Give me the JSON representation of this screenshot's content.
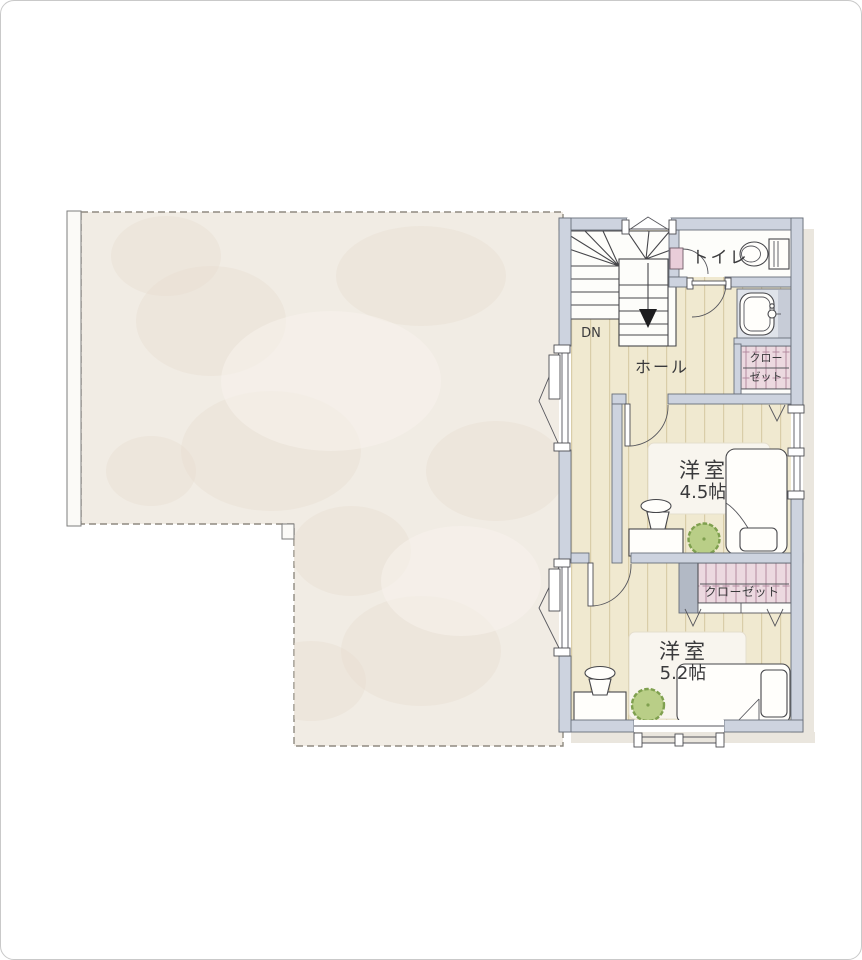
{
  "plan": {
    "labels": {
      "dn": "DN",
      "toilet": "トイレ",
      "hall": "ホール",
      "closet_upper": [
        "クロー",
        "ゼット"
      ],
      "closet_lower": "クローゼット",
      "room_a": {
        "name": "洋室",
        "size": "4.5帖"
      },
      "room_b": {
        "name": "洋室",
        "size": "5.2帖"
      }
    },
    "colors": {
      "wall": "#cdd3df",
      "wood": "#f0e9d0",
      "woodline": "#d9cda8",
      "balcony": "#f1ece4",
      "blotch": "#e7ddcf",
      "closet": "#ecd9e0",
      "closetline": "#b48ba0",
      "pink": "#e9cdd9",
      "plant": "#b9ce87",
      "plantedge": "#7fa04f",
      "line": "#3f4042",
      "floor": "#fdfdfa",
      "shadow": "#eae6de",
      "gray": "#b2b9c5",
      "text": "#3a3a3c",
      "frame": "#c9c9c9"
    }
  }
}
